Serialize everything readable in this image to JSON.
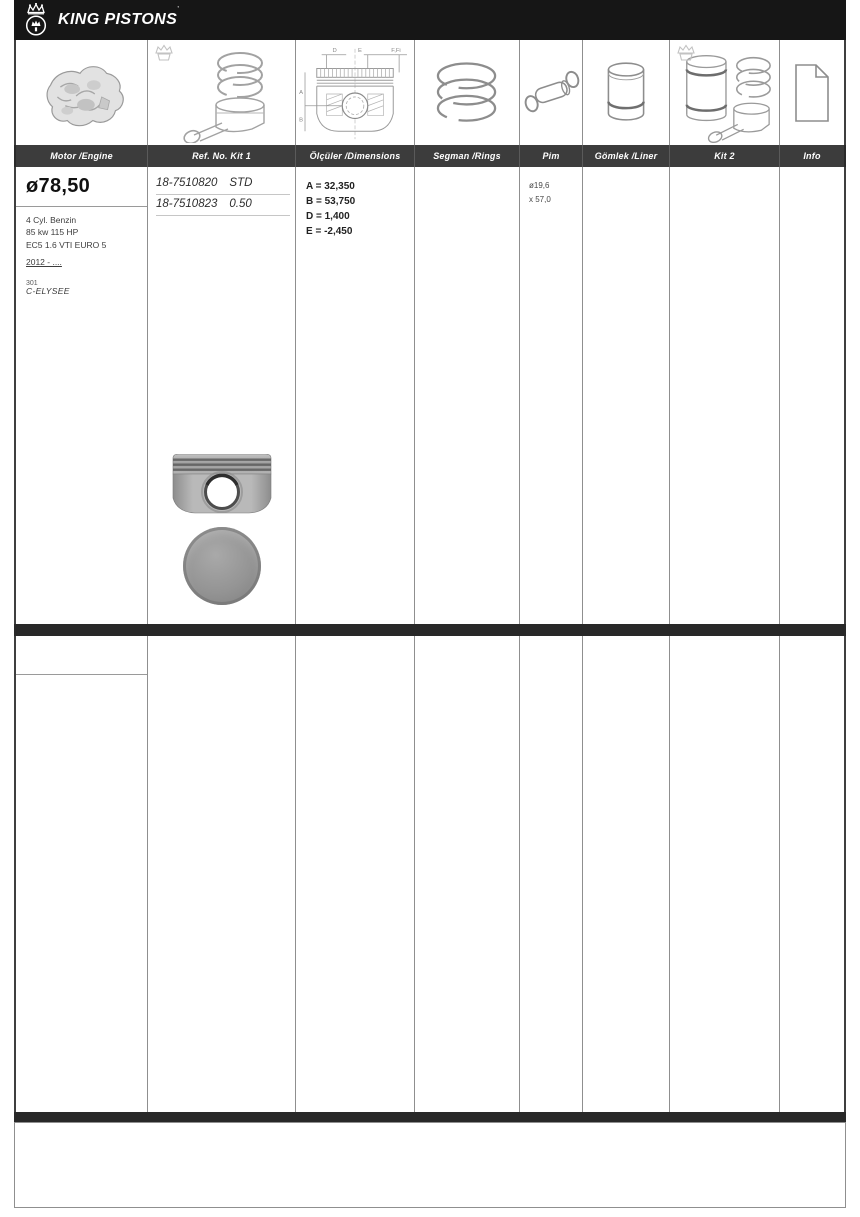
{
  "brand": {
    "name": "KING PISTONS",
    "trademark": "’"
  },
  "colors": {
    "brandbar_bg": "#161616",
    "subheader_bg": "#3c3c3c",
    "separator_bar": "#282828",
    "grid_line": "#8f8f8f",
    "text_dark": "#2d2d2d"
  },
  "columns": [
    {
      "id": "motor",
      "label": "Motor /Engine"
    },
    {
      "id": "ref-kit1",
      "label": "Ref. No. Kit 1"
    },
    {
      "id": "dimensions",
      "label": "Ölçüler /Dimensions"
    },
    {
      "id": "rings",
      "label": "Segman /Rings"
    },
    {
      "id": "pin",
      "label": "Pim"
    },
    {
      "id": "liner",
      "label": "Gömlek /Liner"
    },
    {
      "id": "kit2",
      "label": "Kit 2"
    },
    {
      "id": "info",
      "label": "Info"
    }
  ],
  "icons": {
    "header_logo": "crown-emblem-icon",
    "column_icons": [
      "engine-icon",
      "piston-kit1-icon",
      "piston-dimensions-diagram-icon",
      "rings-icon",
      "pin-icon",
      "liner-icon",
      "piston-kit2-icon",
      "info-sheet-icon"
    ]
  },
  "diagram": {
    "labels": {
      "d": "D",
      "e": "E",
      "f": "F,Fi",
      "a": "A",
      "b": "B"
    }
  },
  "row1": {
    "bore": "ø78,50",
    "specs": [
      "4 Cyl. Benzin",
      "85 kw 115 HP",
      "EC5 1.6 VTI EURO 5"
    ],
    "year_range": "2012 - ....",
    "model_small": "301",
    "model": "C-ELYSEE",
    "refs": [
      {
        "number": "18-7510820",
        "size": "STD"
      },
      {
        "number": "18-7510823",
        "size": "0.50"
      }
    ],
    "dims": [
      "A = 32,350",
      "B = 53,750",
      "D = 1,400",
      "E = -2,450"
    ],
    "pin": [
      "ø19,6",
      "x 57,0"
    ],
    "images": [
      "piston-side-photo",
      "piston-top-photo"
    ]
  }
}
